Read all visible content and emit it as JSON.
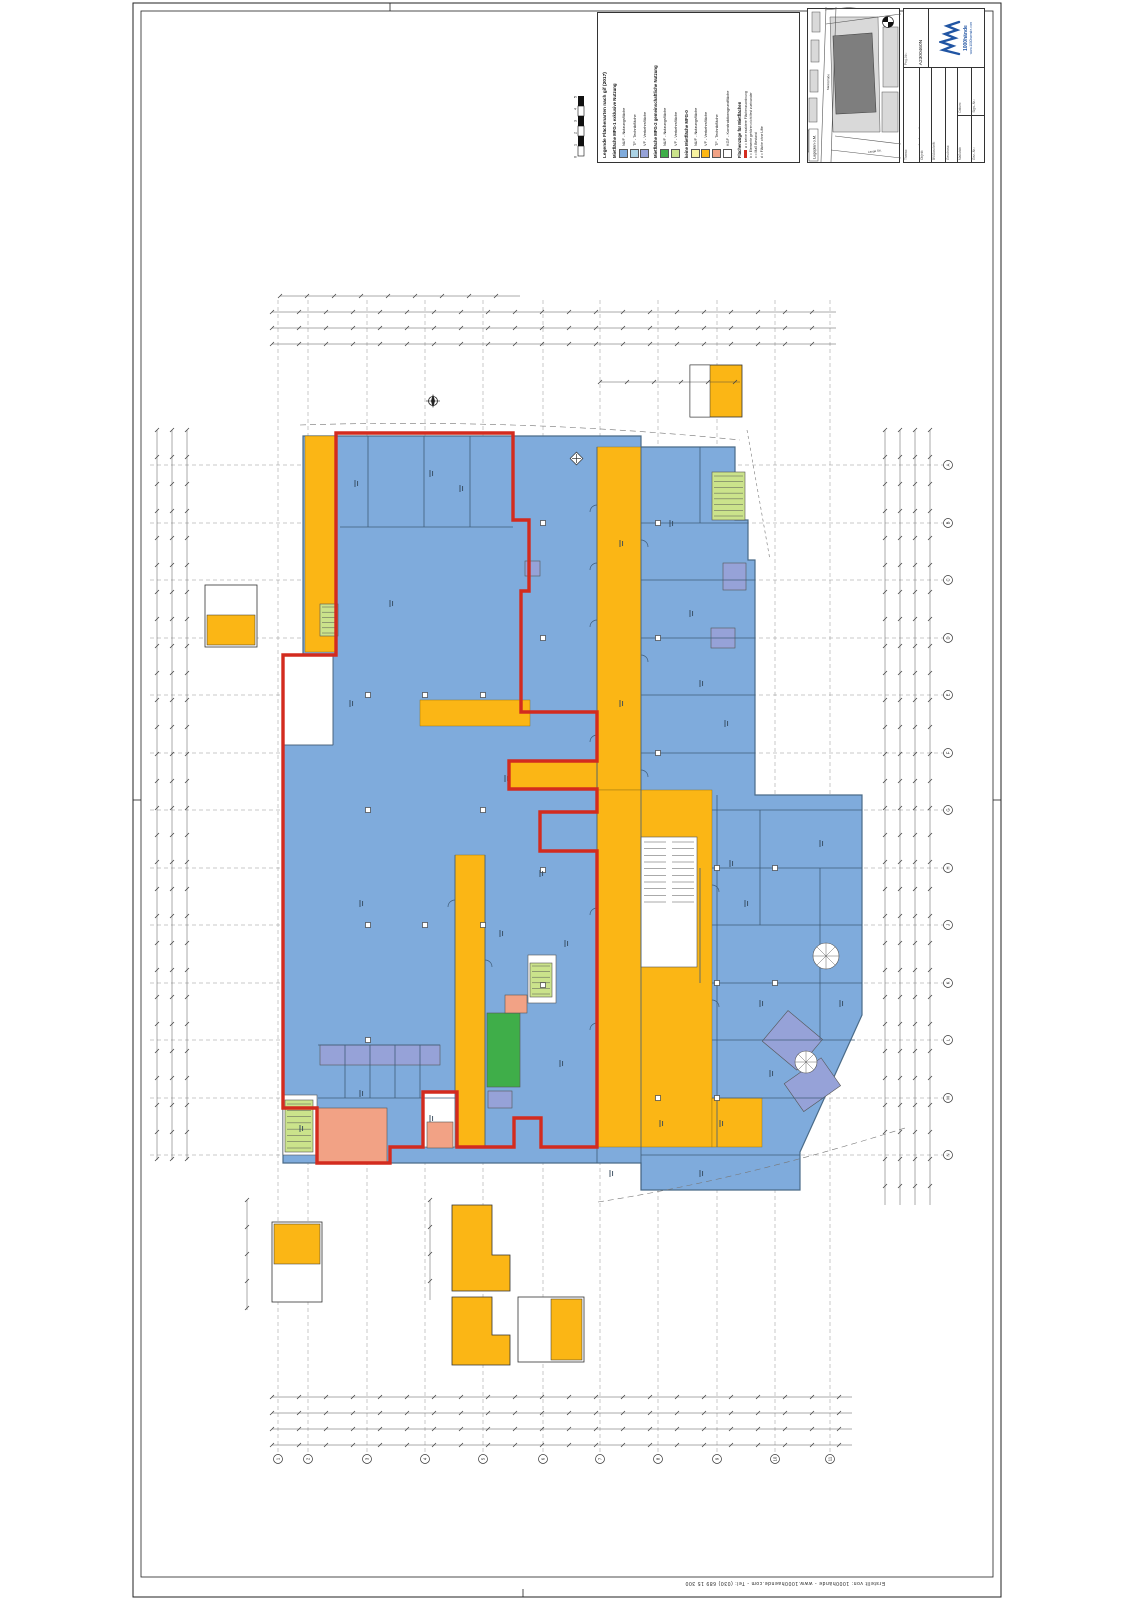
{
  "sheet": {
    "credit": "Erstellt von: 1000hände  -  www.1000haende.com  -  Tel: (030) 689 15 300"
  },
  "legend": {
    "title": "Legende Flächenarten nach gif (2017)",
    "groups": [
      {
        "header": "Mietfläche MFG-1 exklusive Nutzung",
        "items": [
          {
            "label": "NUF - Nutzungsfläche",
            "color": "#7fabdc"
          },
          {
            "label": "TF - Technikfläche",
            "color": "#aad2e4"
          },
          {
            "label": "VF - Verkehrsfläche",
            "color": "#96a2d8"
          }
        ]
      },
      {
        "header": "Mietfläche MFG-2 gemeinschaftliche Nutzung",
        "items": [
          {
            "label": "NUF - Nutzungsfläche",
            "color": "#3fae49"
          },
          {
            "label": "VF - Verkehrsfläche",
            "color": "#cbe38b"
          }
        ]
      },
      {
        "header": "keine Mietfläche MFG-0",
        "items": [
          {
            "label": "NUF - Nutzungsfläche",
            "color": "#f8f2a0"
          },
          {
            "label": "VF - Verkehrsfläche",
            "color": "#fbb615"
          },
          {
            "label": "TF - Technikfläche",
            "color": "#f2a285"
          },
          {
            "label": "KGF - Konstruktionsgrundfläche",
            "color": "#ffffff"
          }
        ]
      }
    ],
    "notes_header": "Flächenzüge für Mietflächen",
    "notes": [
      "a = keine exaktere Flächenzuordnung",
      "b = Elemente gehören nicht fest zueinander",
      "c = Maß Bestand",
      "d = Fläche ohne Lifte"
    ]
  },
  "site_map": {
    "caption": "Lageplan o.M.",
    "street_a": "Lange Str.",
    "street_b": "Marktstraße"
  },
  "title_block": {
    "proj_label": "Proj.-Nr.:",
    "proj_value": "A2300460N",
    "fields": [
      {
        "label": "Thema:",
        "value": "RM - Flächenplan"
      },
      {
        "label": "Objekt:",
        "value": "Kaufpark"
      },
      {
        "label": "BV/Anschrift:",
        "value": "27749 Delmenhorst, Lange Str. 4-6"
      },
      {
        "label": "Geschoss:",
        "value": "Erdgeschoss"
      }
    ],
    "scale_label": "Maßstab:",
    "scale_value": "1:100/A0",
    "date_label": "Datum:",
    "date_value": "15.12.2023",
    "drawn_label": "Gez.-Nr.:",
    "sign_label": "Sign.-Nr.:",
    "logo_name": "1000hände",
    "logo_sub": "www.1000haende.com"
  },
  "axes": {
    "bottom": [
      "1",
      "2",
      "3",
      "4",
      "5",
      "6",
      "7",
      "8",
      "9",
      "10",
      "11"
    ],
    "right": [
      "A",
      "B",
      "C",
      "D",
      "E",
      "F",
      "G",
      "H",
      "J",
      "K",
      "L",
      "M",
      "N"
    ]
  },
  "scale_bar": {
    "labels": [
      "0",
      "1",
      "2",
      "3",
      "4",
      "5"
    ],
    "unit": "m"
  },
  "colors": {
    "nuf_mfg1": "#7fabdc",
    "tf_mfg1": "#aad2e4",
    "vf_mfg1": "#96a2d8",
    "nuf_mfg2": "#3fae49",
    "vf_mfg2": "#cbe38b",
    "nuf_mfg0": "#f8f2a0",
    "vf_mfg0": "#fbb615",
    "tf_mfg0": "#f2a285",
    "kgf": "#ffffff",
    "boundary_red": "#d32b1e"
  }
}
